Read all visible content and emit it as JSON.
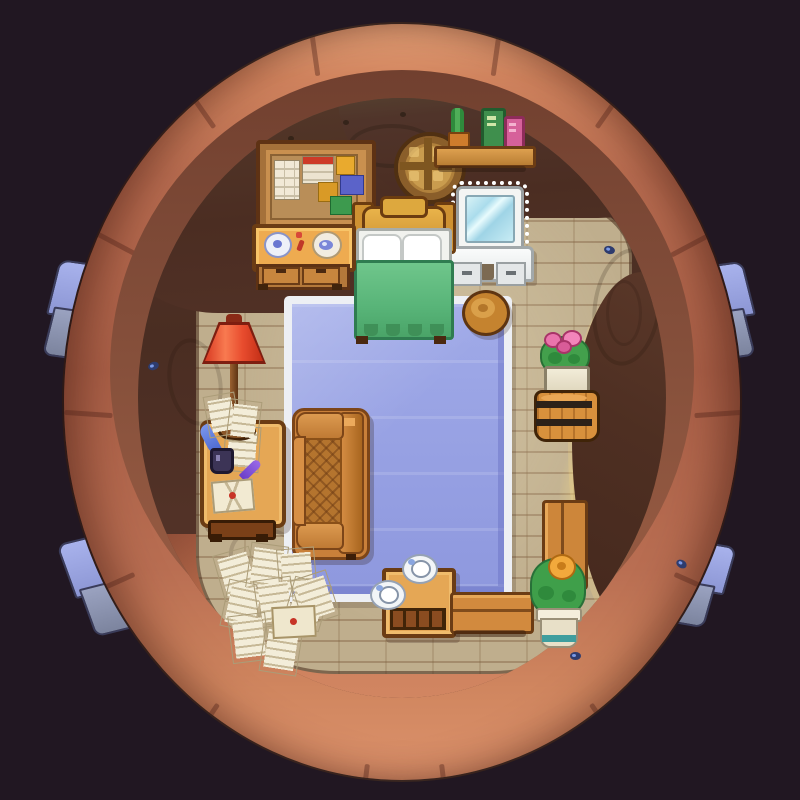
{
  "scene": {
    "description": "Top-down pixel-art bedroom inside a hollow acorn-like shell",
    "background_color": "#211722",
    "palette": {
      "shell_rim": "#c77b5e",
      "shell_rim_highlight": "#e09a72",
      "shell_band": "#8a5038",
      "wall_dark": "#4c2f24",
      "wall_top_olive": "#5d5640",
      "floor_wood": "#bfae8d",
      "rug_blue": "#95a0e2",
      "rug_border": "#edeff4",
      "lamp_red": "#e84c2e",
      "blanket_green": "#58b478",
      "furniture_wood": "#e5a755",
      "light_glow": "#fcde82",
      "growth_blue": "#98a4e0"
    }
  },
  "objects": {
    "bulletin_board": {
      "label": "bulletin board with calendar, memo and sticky notes"
    },
    "porthole_window": {
      "label": "round porthole window"
    },
    "wall_shelf": {
      "label": "wall shelf with cactus, green book and pink book"
    },
    "vanity": {
      "label": "lighted vanity mirror with drawers"
    },
    "bed": {
      "label": "wooden bed with white pillows and green blanket"
    },
    "dresser": {
      "label": "dresser with wreath plate, red trinket and bowl"
    },
    "stool": {
      "label": "round wooden stool"
    },
    "floor_lamp": {
      "label": "red floor lamp"
    },
    "writing_desk": {
      "label": "writing desk with quill, ink bottle, letters and envelope"
    },
    "armchair": {
      "label": "quilted leather armchair"
    },
    "rug": {
      "label": "blue rectangular rug with white border"
    },
    "barrel_planter": {
      "label": "barrel with potted pink flowers"
    },
    "bench_vertical": {
      "label": "wooden bench"
    },
    "bench_horizontal": {
      "label": "wooden bench"
    },
    "yellow_plant": {
      "label": "potted yellow flower"
    },
    "tea_table": {
      "label": "tea table with two teacups"
    },
    "letters_pile": {
      "label": "scattered letters and sealed envelope"
    },
    "growth": {
      "label": "blue growth poking from behind the shell"
    },
    "bug": {
      "label": "small blue bug"
    },
    "light_pool": {
      "label": "warm light from opening in right wall"
    }
  }
}
